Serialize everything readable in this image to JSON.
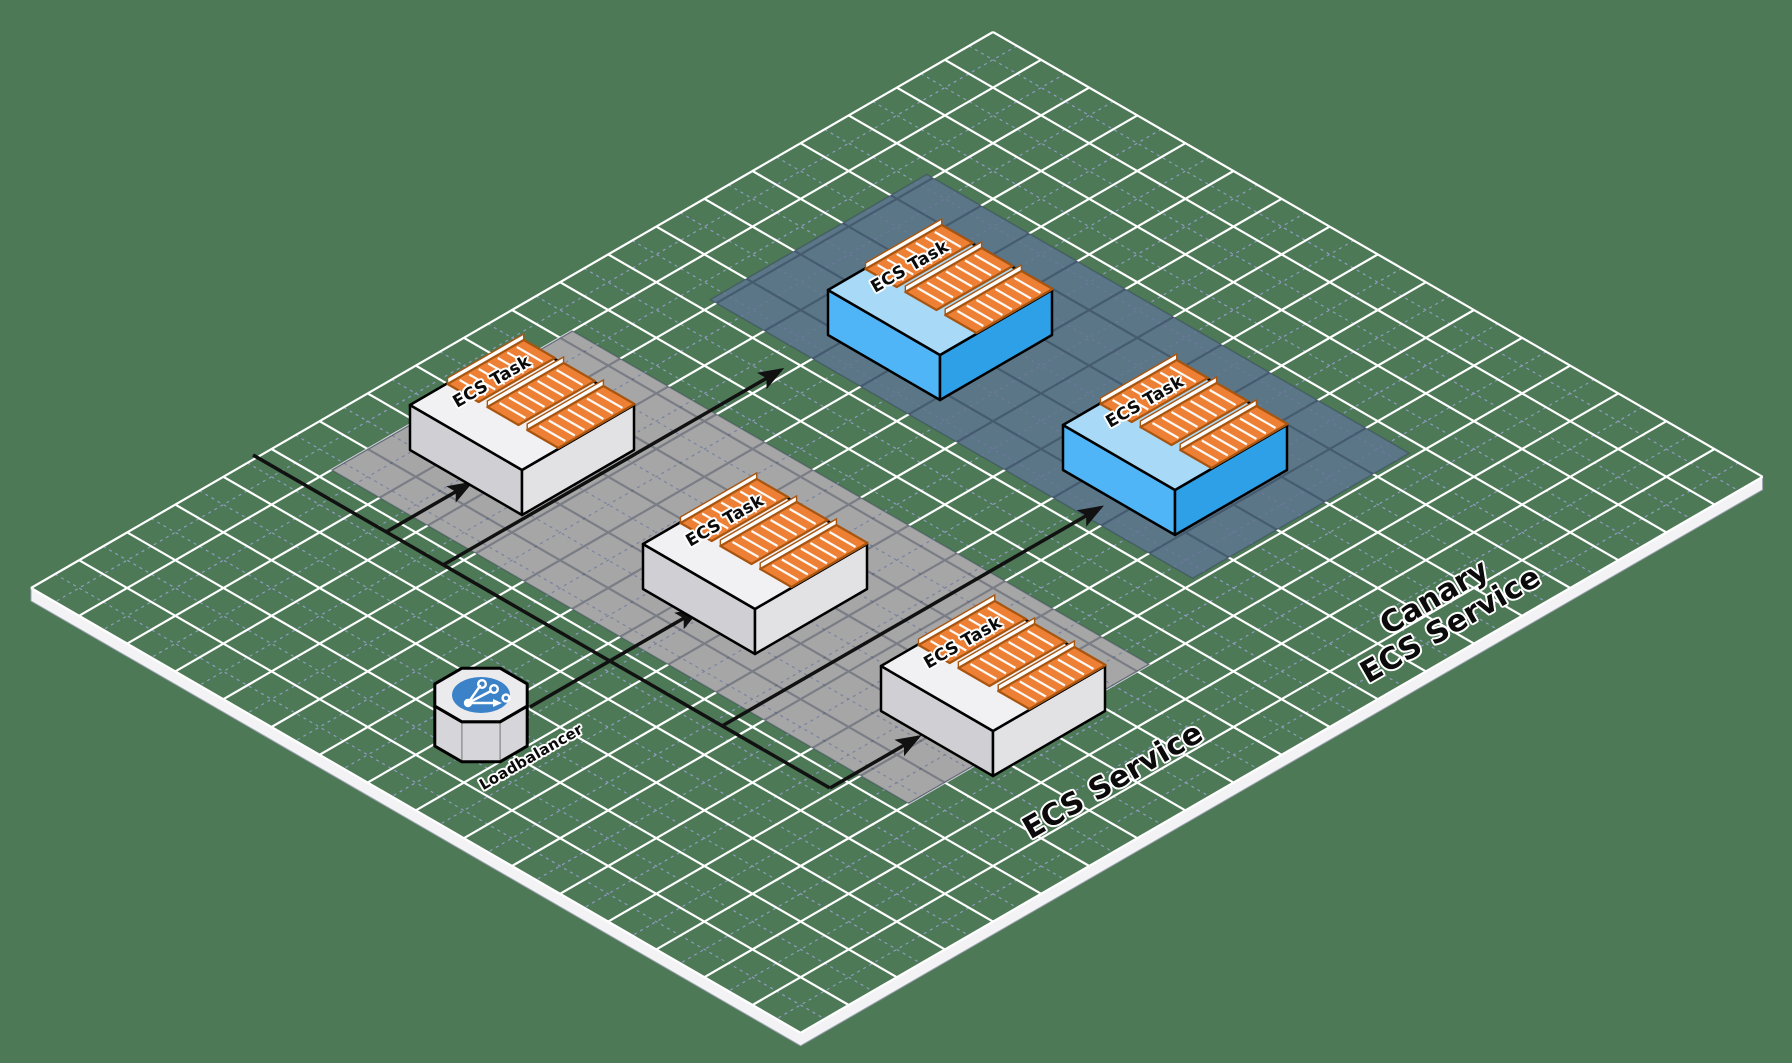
{
  "diagram_type": "isometric-architecture",
  "services": [
    {
      "id": "ecs-service",
      "label": "ECS Service"
    },
    {
      "id": "canary-ecs-service",
      "label_lines": [
        "Canary",
        "ECS Service"
      ]
    }
  ],
  "loadbalancer": {
    "label": "Loadbalancer",
    "icon": "load-balancer-branch-icon"
  },
  "tasks": [
    {
      "label": "ECS Task",
      "service": "ecs-service"
    },
    {
      "label": "ECS Task",
      "service": "ecs-service"
    },
    {
      "label": "ECS Task",
      "service": "ecs-service"
    },
    {
      "label": "ECS Task",
      "service": "canary-ecs-service"
    },
    {
      "label": "ECS Task",
      "service": "canary-ecs-service"
    }
  ],
  "containers_per_task": 3,
  "colors": {
    "background": "#4d7956",
    "grid_major": "#ffffff",
    "grid_minor": "#96a0cf",
    "ecs_band": "#a6a6a6",
    "canary_band": "#5b7687",
    "task_top": "#f1f1f3",
    "task_side_left": "#d0d0d4",
    "task_side_right": "#e2e2e5",
    "canary_top": "#a8daf8",
    "canary_side_left": "#4fb5f6",
    "canary_side_right": "#2da0e8",
    "container_fill": "#ed8035",
    "container_border": "#a85510",
    "connector": "#111111",
    "loadbalancer_circle": "#3c82c8",
    "plane_edge": "#f3f3f5"
  }
}
